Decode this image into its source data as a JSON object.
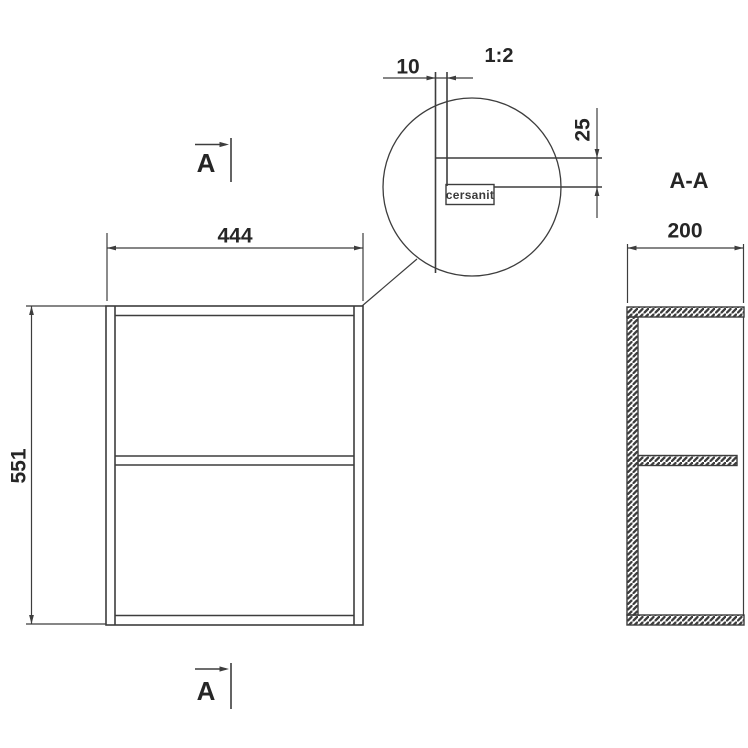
{
  "title": "Cersanit open wall cabinet technical drawing",
  "brand_label": "cersanit",
  "detail_scale": "1:2",
  "section": {
    "label": "A-A",
    "marker": "A"
  },
  "dimensions": {
    "width": "444",
    "height": "551",
    "depth": "200",
    "panel_thickness": "10",
    "logo_offset": "25"
  },
  "colors": {
    "line": "#3d3d3d",
    "text": "#262626",
    "background": "#ffffff"
  }
}
